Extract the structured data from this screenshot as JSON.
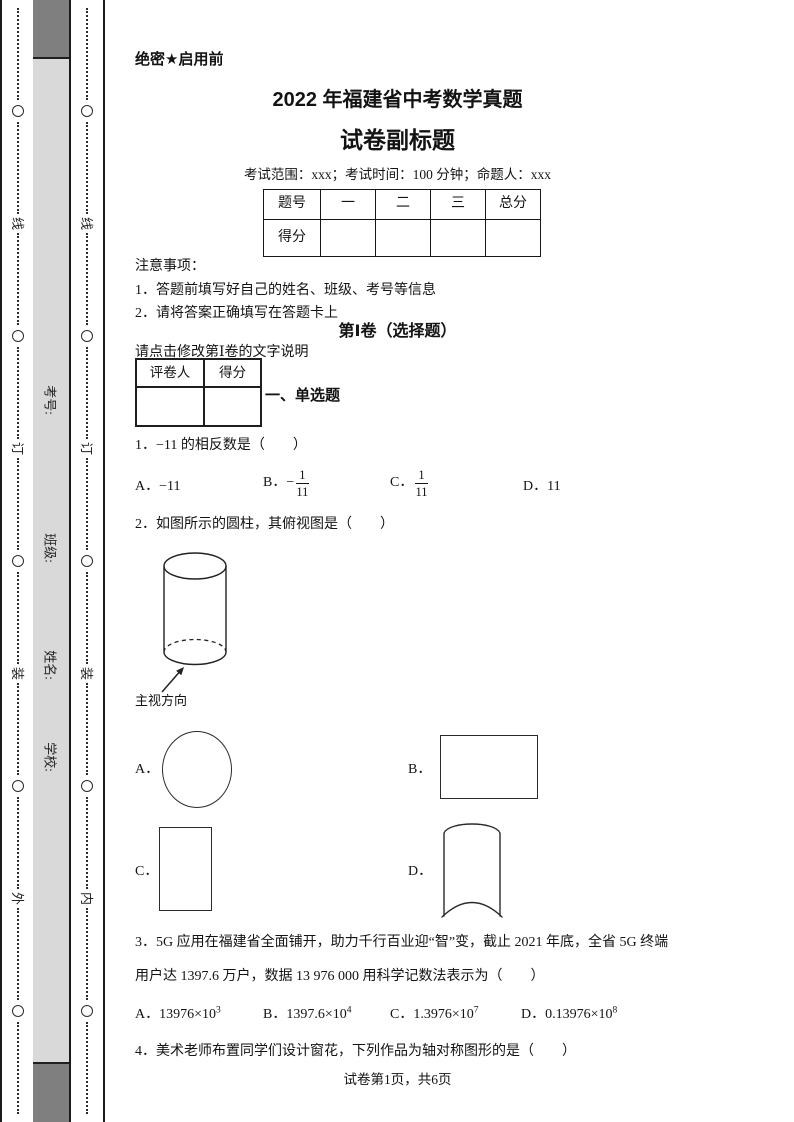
{
  "page": {
    "secret_label": "绝密★启用前",
    "title": "2022 年福建省中考数学真题",
    "subtitle": "试卷副标题",
    "exam_info": "考试范围：xxx；考试时间：100 分钟；命题人：xxx",
    "footer": "试卷第1页，共6页"
  },
  "binding_margin": {
    "outer_chars": [
      "线",
      "订",
      "装",
      "外"
    ],
    "inner_chars": [
      "线",
      "订",
      "装",
      "内"
    ],
    "fields": [
      "考号:",
      "班级:",
      "姓名:",
      "学校:"
    ]
  },
  "score_table": {
    "headers": [
      "题号",
      "一",
      "二",
      "三",
      "总分"
    ],
    "row_label": "得分"
  },
  "notes": {
    "heading": "注意事项：",
    "item1": "1．答题前填写好自己的姓名、班级、考号等信息",
    "item2": "2．请将答案正确填写在答题卡上"
  },
  "section1": {
    "heading": "第Ⅰ卷（选择题）",
    "note": "请点击修改第Ⅰ卷的文字说明",
    "grader_label": "评卷人",
    "score_label": "得分",
    "subsection": "一、单选题"
  },
  "q1": {
    "stem": "1．−11 的相反数是（　　）",
    "a_label": "A．",
    "a_text": "−11",
    "b_label": "B．",
    "b_minus": "−",
    "b_num": "1",
    "b_den": "11",
    "c_label": "C．",
    "c_num": "1",
    "c_den": "11",
    "d_label": "D．",
    "d_text": "11"
  },
  "q2": {
    "stem": "2．如图所示的圆柱，其俯视图是（　　）",
    "figure_label": "主视方向",
    "a_label": "A．",
    "b_label": "B．",
    "c_label": "C．",
    "d_label": "D．"
  },
  "q3": {
    "stem_line1": "3．5G 应用在福建省全面铺开，助力千行百业迎“智”变，截止 2021 年底，全省 5G 终端",
    "stem_line2": "用户达 1397.6 万户，数据 13 976 000 用科学记数法表示为（　　）",
    "options": [
      {
        "label": "A．",
        "base": "13976×10",
        "exp": "3"
      },
      {
        "label": "B．",
        "base": "1397.6×10",
        "exp": "4"
      },
      {
        "label": "C．",
        "base": "1.3976×10",
        "exp": "7"
      },
      {
        "label": "D．",
        "base": "0.13976×10",
        "exp": "8"
      }
    ]
  },
  "q4": {
    "stem": "4．美术老师布置同学们设计窗花，下列作品为轴对称图形的是（　　）"
  }
}
